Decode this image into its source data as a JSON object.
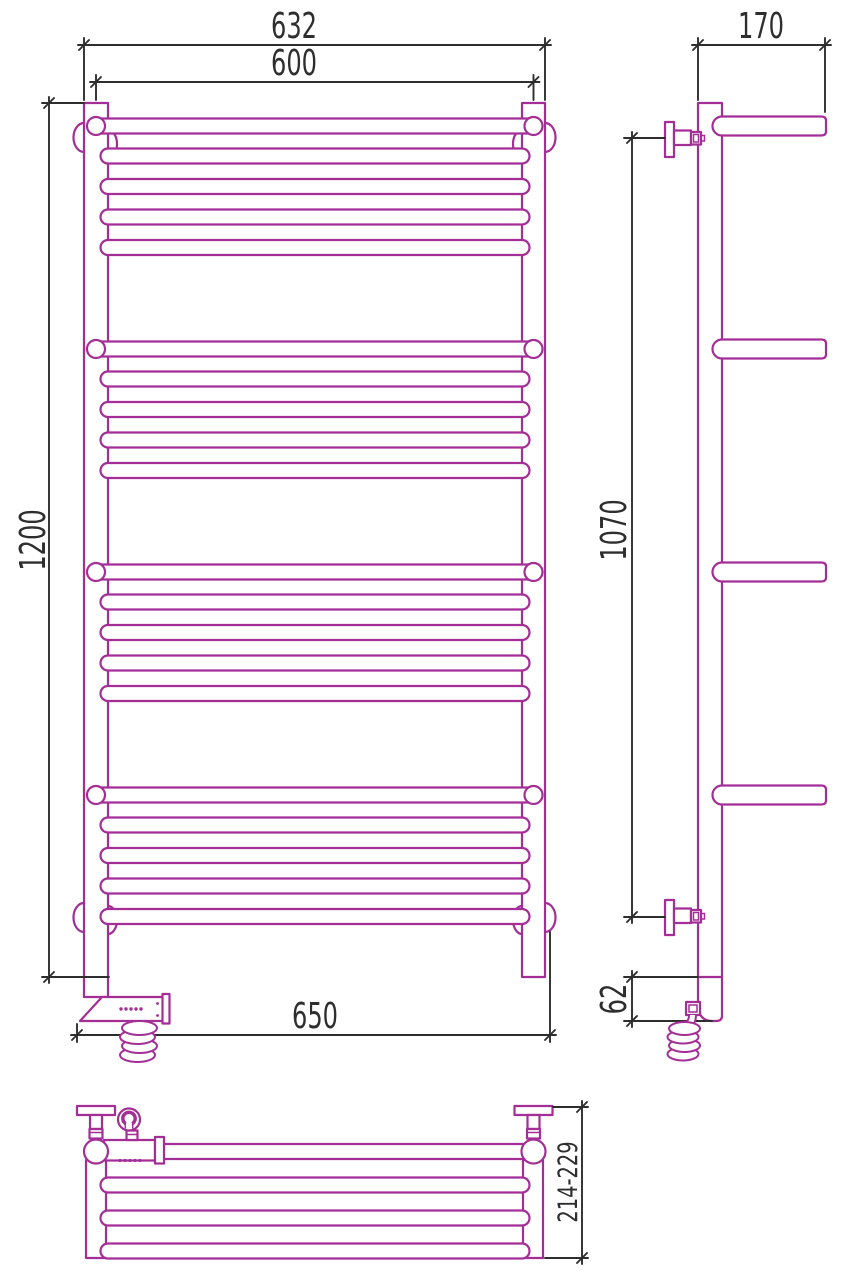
{
  "colors": {
    "outline": "#a32e96",
    "dimension_lines": "#2e2e2e",
    "background": "#ffffff"
  },
  "dimensions": {
    "front_top_outer_width": "632",
    "front_top_center_width": "600",
    "front_height": "1200",
    "front_bottom_width": "650",
    "side_top_depth": "170",
    "side_bracket_span": "1070",
    "side_bottom_offset": "62",
    "plan_wall_distance": "214-229"
  }
}
